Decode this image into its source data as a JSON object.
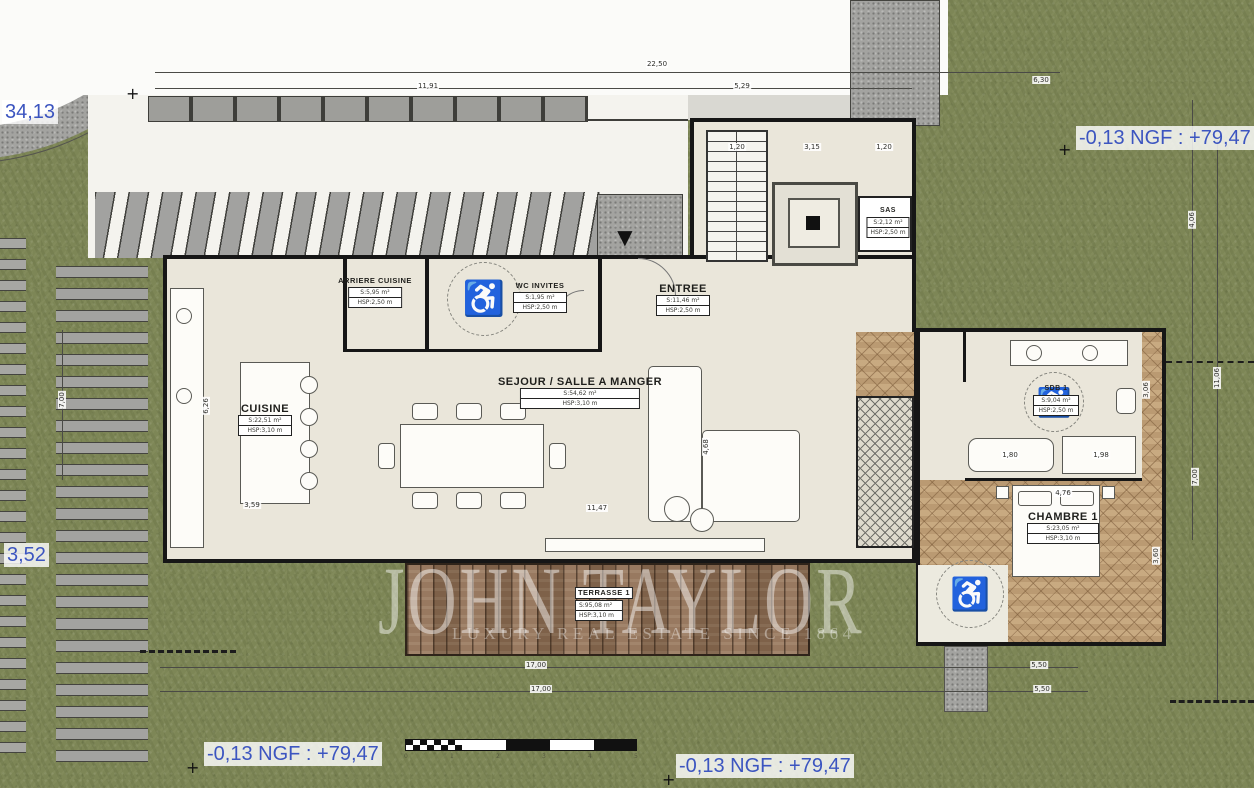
{
  "colors": {
    "grass": "#7d8656",
    "road_gray": "#a3a3a1",
    "floor_cream": "#eae6da",
    "wall_black": "#161616",
    "terrace_wood": "#8f6e53",
    "parquet": "#c6a77e",
    "accent_blue": "#3c55c0"
  },
  "watermark": {
    "title": "JOHN TAYLOR",
    "subtitle": "LUXURY REAL ESTATE SINCE 1864"
  },
  "levels": {
    "top_left": "34,13",
    "left": "3,52",
    "top_right": "-0,13 NGF : +79,47",
    "bottom_left": "-0,13 NGF : +79,47",
    "bottom_center": "-0,13 NGF : +79,47"
  },
  "icons": {
    "wheelchair": "♿",
    "survey_cross": "+",
    "entrance_arrow": "▼"
  },
  "rooms": [
    {
      "id": "arriere-cuisine",
      "name": "ARRIERE CUISINE",
      "area": "S:5,95 m²",
      "hsp": "HSP:2,50 m"
    },
    {
      "id": "wc-invites",
      "name": "WC INVITES",
      "area": "S:1,95 m²",
      "hsp": "HSP:2,50 m"
    },
    {
      "id": "entree",
      "name": "ENTREE",
      "area": "S:11,46 m²",
      "hsp": "HSP:2,50 m"
    },
    {
      "id": "sas",
      "name": "SAS",
      "area": "S:2,12 m²",
      "hsp": "HSP:2,50 m"
    },
    {
      "id": "cuisine",
      "name": "CUISINE",
      "area": "S:22,51 m²",
      "hsp": "HSP:3,10 m"
    },
    {
      "id": "sejour-salle-a-manger",
      "name": "SEJOUR / SALLE A MANGER",
      "area": "S:54,62 m²",
      "hsp": "HSP:3,10 m"
    },
    {
      "id": "sdb-1",
      "name": "SDB 1",
      "area": "S:9,04 m²",
      "hsp": "HSP:2,50 m"
    },
    {
      "id": "chambre-1",
      "name": "CHAMBRE 1",
      "area": "S:23,05 m²",
      "hsp": "HSP:3,10 m"
    },
    {
      "id": "terrasse-1",
      "name": "TERRASSE 1",
      "area": "S:95,08 m²",
      "hsp": "HSP:3,10 m"
    }
  ],
  "dimensions": [
    {
      "t": "22,50",
      "x": 657,
      "y": 64
    },
    {
      "t": "11,91",
      "x": 428,
      "y": 86
    },
    {
      "t": "5,29",
      "x": 742,
      "y": 86
    },
    {
      "t": "6,30",
      "x": 1041,
      "y": 80
    },
    {
      "t": "1,20",
      "x": 737,
      "y": 147
    },
    {
      "t": "3,15",
      "x": 812,
      "y": 147
    },
    {
      "t": "1,20",
      "x": 884,
      "y": 147
    },
    {
      "t": "6,26",
      "x": 206,
      "y": 406,
      "r": 1
    },
    {
      "t": "3,59",
      "x": 252,
      "y": 505
    },
    {
      "t": "11,47",
      "x": 597,
      "y": 508
    },
    {
      "t": "4,68",
      "x": 706,
      "y": 447,
      "r": 1
    },
    {
      "t": "4,76",
      "x": 1063,
      "y": 493
    },
    {
      "t": "1,80",
      "x": 1010,
      "y": 455
    },
    {
      "t": "1,98",
      "x": 1101,
      "y": 455
    },
    {
      "t": "3,06",
      "x": 1146,
      "y": 390,
      "r": 1
    },
    {
      "t": "4,06",
      "x": 1192,
      "y": 220,
      "r": 1
    },
    {
      "t": "11,06",
      "x": 1217,
      "y": 378,
      "r": 1
    },
    {
      "t": "7,00",
      "x": 1195,
      "y": 477,
      "r": 1
    },
    {
      "t": "7,00",
      "x": 62,
      "y": 400,
      "r": 1
    },
    {
      "t": "3,60",
      "x": 1156,
      "y": 556,
      "r": 1
    },
    {
      "t": "17,00",
      "x": 536,
      "y": 665
    },
    {
      "t": "17,00",
      "x": 541,
      "y": 689
    },
    {
      "t": "5,50",
      "x": 1039,
      "y": 665
    },
    {
      "t": "5,50",
      "x": 1042,
      "y": 689
    }
  ],
  "scale_bar": {
    "numbers": [
      "0",
      "1",
      "2",
      "3",
      "4",
      "5"
    ]
  }
}
